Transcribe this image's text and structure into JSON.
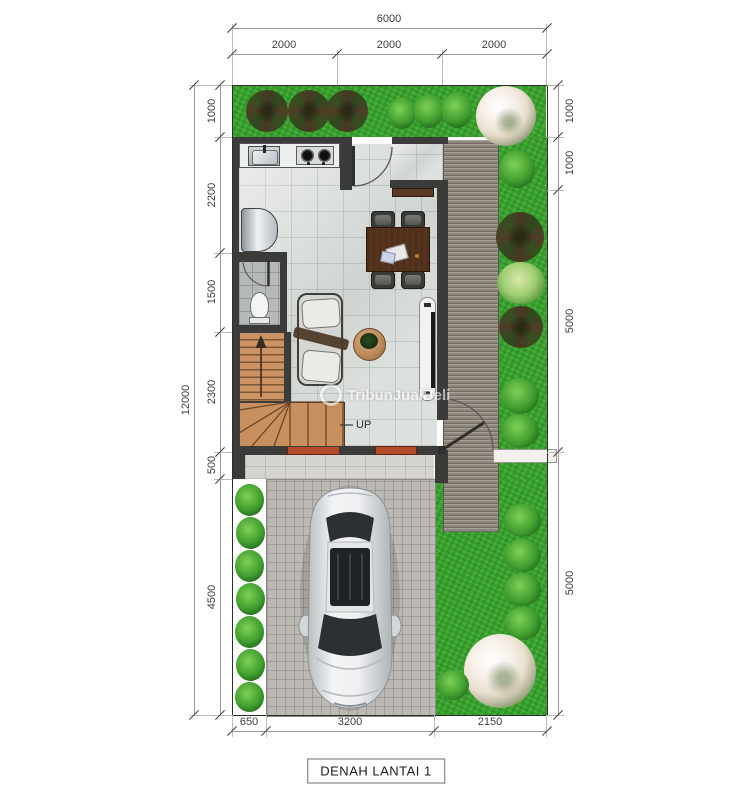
{
  "title": "DENAH LANTAI 1",
  "watermark": {
    "brand": "TribunJualBeli"
  },
  "labels": {
    "up": "UP"
  },
  "dims": {
    "top": {
      "total": "6000",
      "segments": [
        "2000",
        "2000",
        "2000"
      ]
    },
    "left": {
      "total": "12000",
      "segments": [
        "1000",
        "2200",
        "1500",
        "2300",
        "500",
        "4500"
      ]
    },
    "right": {
      "segments": [
        "1000",
        "1000",
        "5000",
        "5000"
      ]
    },
    "bottom": {
      "segments": [
        "650",
        "3200",
        "2150"
      ]
    }
  },
  "palette": {
    "wall": "#3b3b39",
    "grass": "#38a22e",
    "floor_tile": "#dde1dd",
    "wood_stairs": "#c8905e",
    "deck": "#8f877d",
    "pavers": "#bcb8b3",
    "window_accent": "#b34a28",
    "dimension_text": "#3e3e3e"
  }
}
